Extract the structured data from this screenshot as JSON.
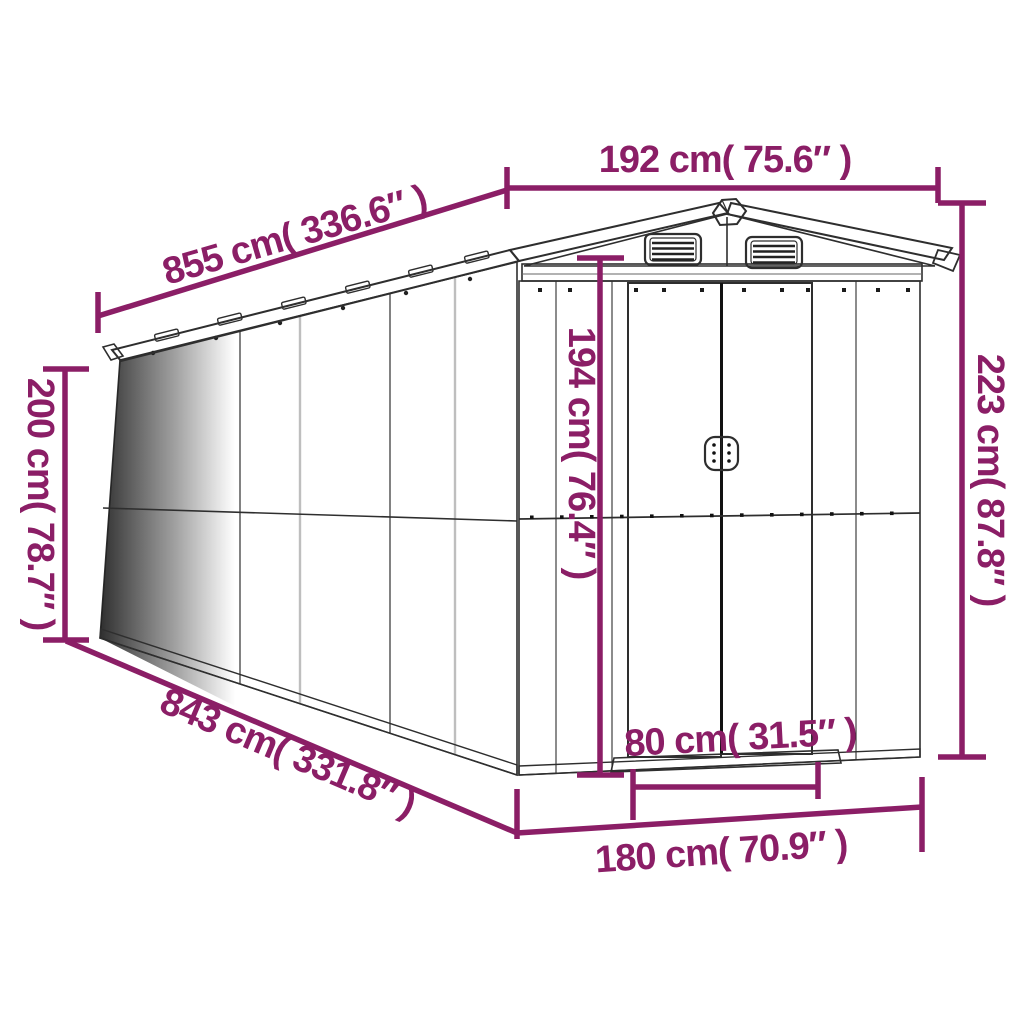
{
  "image": {
    "type": "product-dimension-diagram",
    "subject": "metal garden shed with gable roof, two louver vents and double sliding doors",
    "background_color": "#ffffff",
    "accent_color": "#8B1E66",
    "drawing_line_color": "#2e2e2e"
  },
  "dimensions": {
    "front_width": "192 cm( 75.6″ )",
    "roof_length": "855 cm( 336.6″ )",
    "side_wall_height": "200 cm( 78.7″ )",
    "door_height": "194 cm( 76.4″ )",
    "overall_height": "223 cm( 87.8″ )",
    "base_length": "843 cm( 331.8″ )",
    "door_width": "80 cm( 31.5″ )",
    "front_base_width": "180 cm( 70.9″ )"
  }
}
